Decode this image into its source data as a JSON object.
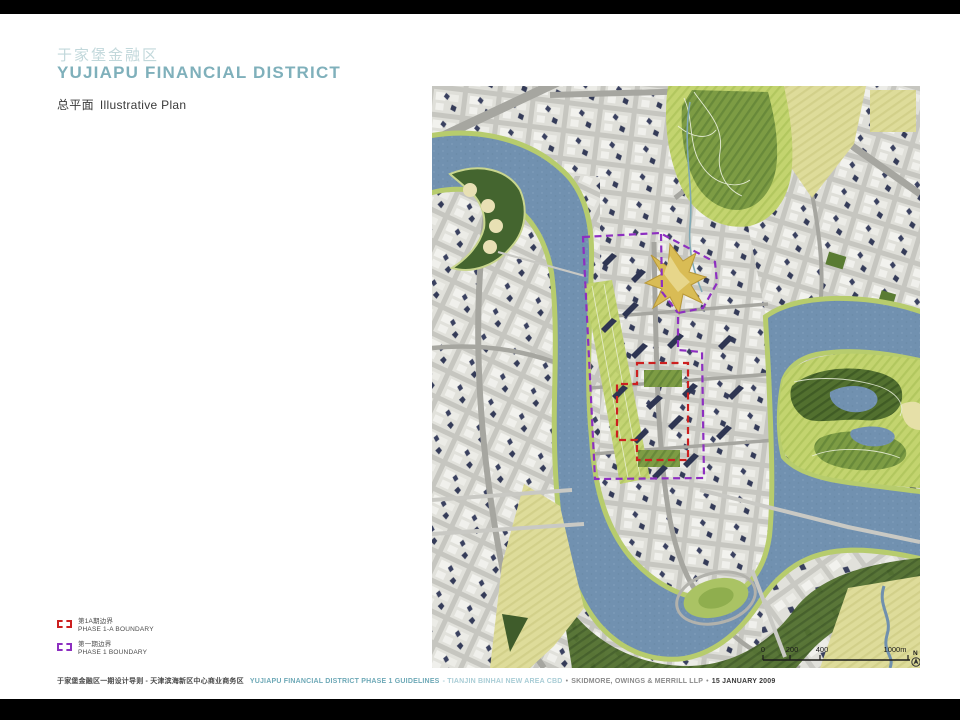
{
  "slide": {
    "title_zh": "于家堡金融区",
    "title_en": "YUJIAPU FINANCIAL DISTRICT",
    "subtitle_zh": "总平面",
    "subtitle_en": "Illustrative Plan"
  },
  "legend": {
    "items": [
      {
        "label_zh": "第1A期边界",
        "label_en": "PHASE 1-A BOUNDARY",
        "color": "#cc2020"
      },
      {
        "label_zh": "第一期边界",
        "label_en": "PHASE 1 BOUNDARY",
        "color": "#8d2fc0"
      }
    ]
  },
  "footer": {
    "project_zh": "于家堡金融区一期设计导则 - 天津滨海新区中心商业商务区",
    "project_en": "YUJIAPU FINANCIAL DISTRICT PHASE 1 GUIDELINES",
    "location": "- TIANJIN BINHAI NEW AREA CBD",
    "sep1": "•",
    "firm": "SKIDMORE, OWINGS & MERRILL LLP",
    "sep2": "•",
    "date": "15 JANUARY 2009"
  },
  "map": {
    "scale": {
      "ticks": [
        "0",
        "200",
        "400",
        "1000m"
      ],
      "north_label": "N"
    },
    "colors": {
      "water": "#7191b0",
      "park_green": "#b7cc6d",
      "dark_green": "#4e6c2f",
      "field_yellow": "#dedc9a",
      "urban_gray": "#d6d6d0",
      "station_gold": "#d9bc55",
      "phase1a_boundary": "#cc2020",
      "phase1_boundary": "#8d2fc0"
    }
  }
}
